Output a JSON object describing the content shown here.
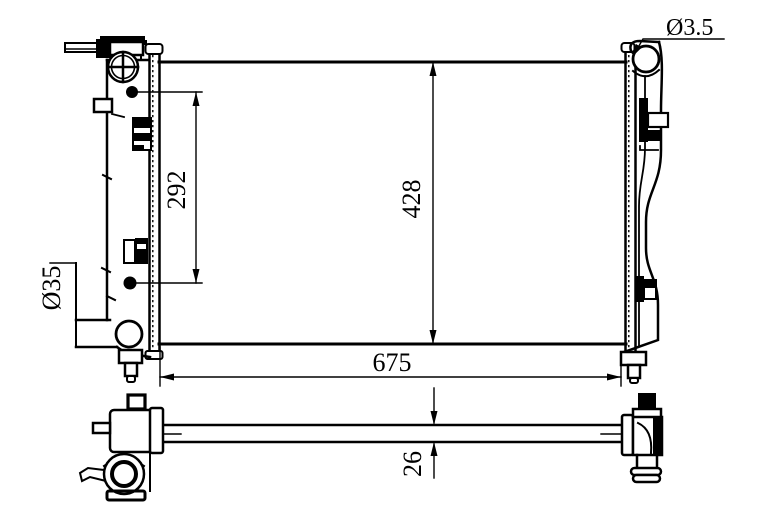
{
  "drawing": {
    "background_color": "#ffffff",
    "line_color": "#000000",
    "labels": {
      "inlet_port_diameter": "Ø3.5",
      "core_height": "428",
      "mounting_span": "292",
      "outlet_pipe_diameter": "Ø35",
      "overall_width": "675",
      "core_thickness": "26"
    }
  }
}
